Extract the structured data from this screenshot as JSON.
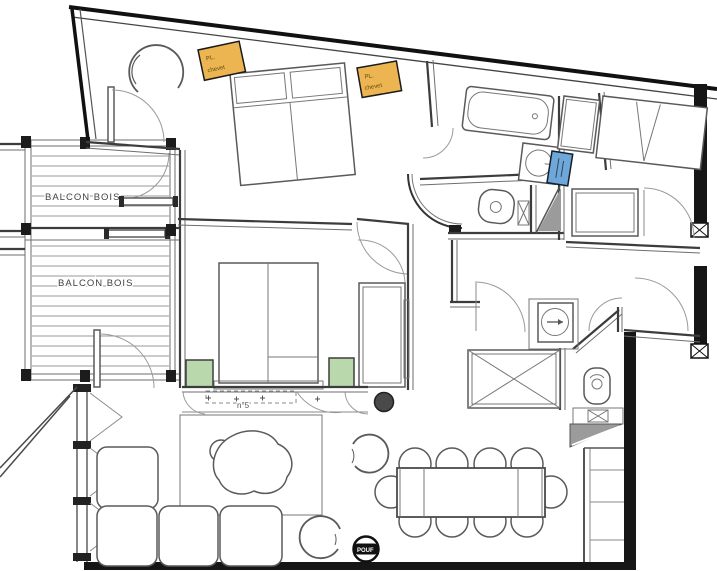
{
  "title": "Apartment floor plan n°5",
  "labels": {
    "balcony_upper": "BALCON BOIS",
    "balcony_lower": "BALCON BOIS",
    "room_number": "n°5",
    "pouf": "POUF"
  },
  "notes": {
    "left_nightstand": {
      "line1": "PL.",
      "line2": "chevet"
    },
    "right_nightstand": {
      "line1": "PL.",
      "line2": "chevet"
    }
  },
  "colors": {
    "note_orange": "#ecb551",
    "note_blue": "#6fa8d8",
    "nightstand_green": "#b9d8ab",
    "column_gray": "#4a4a4a",
    "hatch_gray": "#9b9b9b",
    "wall_dark": "#161616",
    "pouf_black": "#111111"
  }
}
